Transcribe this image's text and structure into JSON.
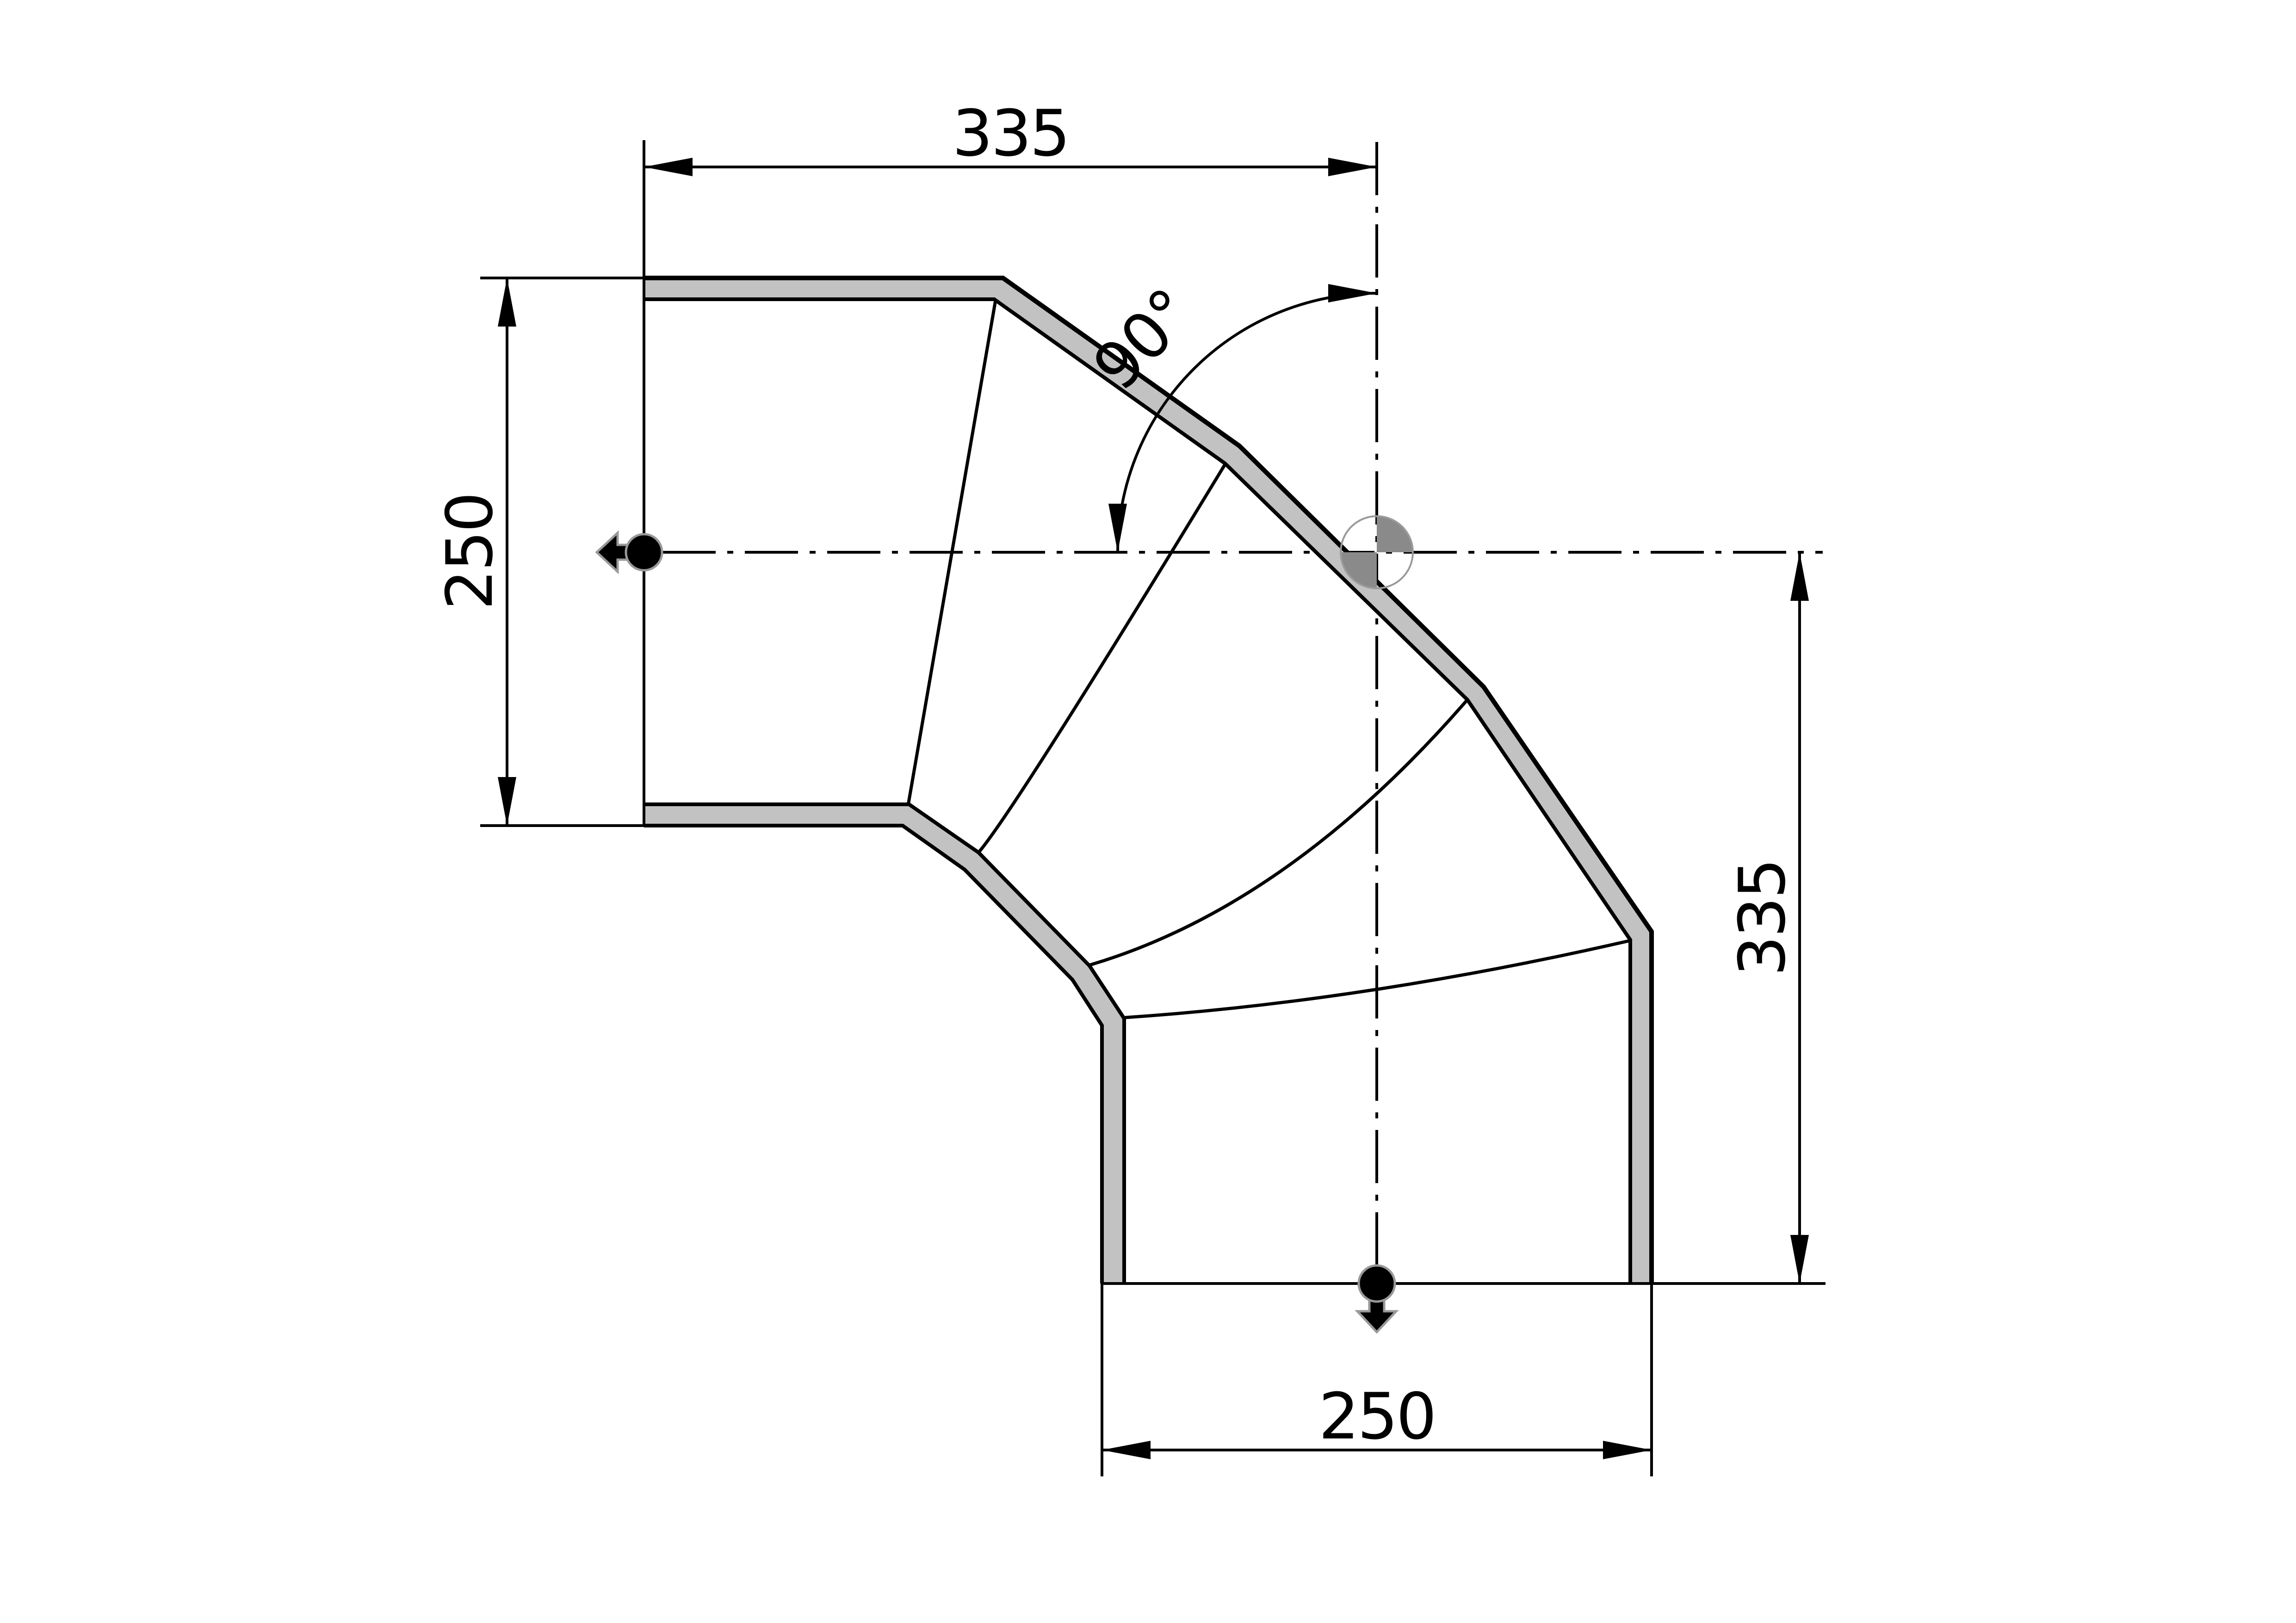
{
  "drawing": {
    "type": "technical-drawing",
    "subject": "90 degree segmented flue elbow, side view",
    "dimensions": {
      "top_width": "335",
      "left_diameter": "250",
      "right_height": "335",
      "bottom_diameter": "250",
      "bend_angle": "90°"
    },
    "colors": {
      "line": "#000000",
      "pipe_wall_fill": "#c2c2c2",
      "target_quadrant_fill": "#8a8a8a",
      "target_ring": "#9a9a9a",
      "flow_symbol_outline": "#999999",
      "background": "#ffffff"
    },
    "symbols": [
      "flow-direction-left-icon",
      "flow-direction-down-icon",
      "center-target-icon"
    ]
  }
}
